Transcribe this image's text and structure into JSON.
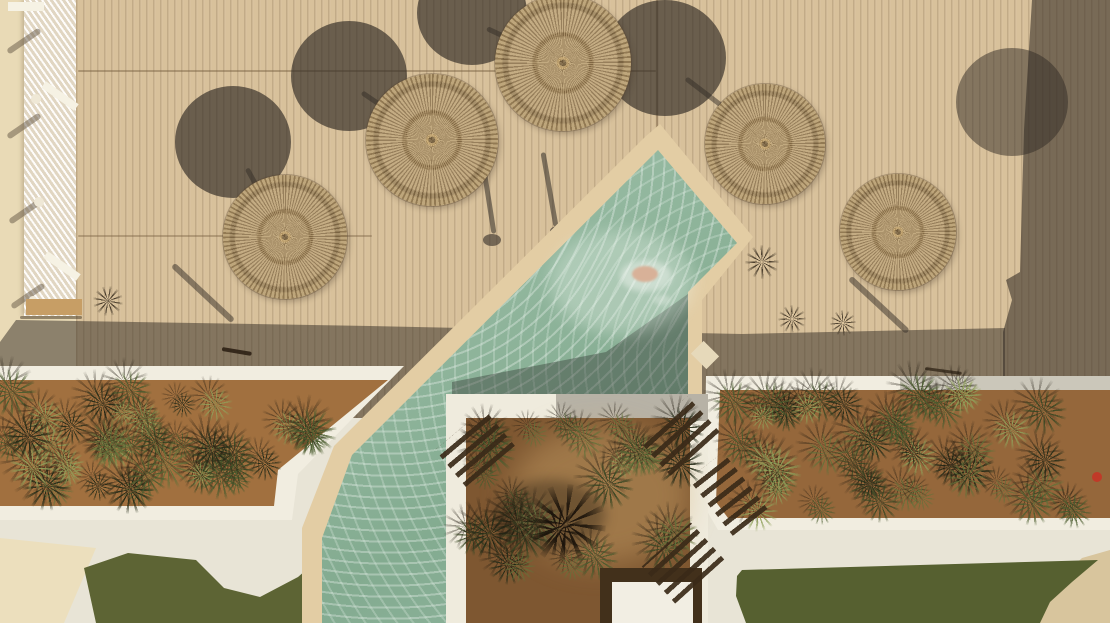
{
  "meta": {
    "description": "Aerial top-down photo of a resort pool deck: five round wicker parasols on tan wood decking casting circular shadows, a diagonal seafoam pool with stone coping, white-walled planters full of agaves, white paths, green lawns and a cream terrace strip with loungers."
  },
  "palette": {
    "ground": "#e7ddc2",
    "cream_strip": "#e9dab6",
    "deck": "#d8c19b",
    "shadow": "rgba(56,48,40,0.55)",
    "umb_shadow": "rgba(48,42,36,0.66)",
    "coping": "#e3cda4",
    "wall_white": "#f1ede0",
    "path": "#e8e4d6",
    "soil_left": "#a1703f",
    "soil_right": "#95673b",
    "soil_center": "#7e5731",
    "lawn_left": "#5d6434",
    "lawn_right": "#566030",
    "sand": "#d8c59d",
    "water_mid": "#92b79e",
    "platform_frame": "#42301b",
    "platform": "#f2eee3",
    "plant_colors": [
      "#252c18",
      "#3a4824",
      "#4a5c2e",
      "#64713a",
      "#8fa05a"
    ]
  },
  "layers": [
    {
      "t": "rect",
      "name": "base-ground",
      "x": 0,
      "y": 0,
      "w": 1110,
      "h": 623,
      "bg": "#e7ddc2"
    },
    {
      "t": "rect",
      "name": "terrace-cream-strip",
      "x": 0,
      "y": 0,
      "w": 80,
      "h": 420,
      "bg": "#e9dab6"
    },
    {
      "t": "rect",
      "name": "wood-deck",
      "x": 76,
      "y": 0,
      "w": 1034,
      "h": 418,
      "bg": "#d8c19b"
    },
    {
      "t": "rect",
      "name": "deck-plank-lines",
      "x": 76,
      "y": 0,
      "w": 1034,
      "h": 418,
      "cls": "planks"
    },
    {
      "t": "line",
      "name": "deck-seam",
      "x1": 78,
      "y1": 71,
      "x2": 656,
      "y2": 71,
      "w": 1.6,
      "bg": "rgba(120,95,65,0.45)"
    },
    {
      "t": "line",
      "name": "deck-seam",
      "x1": 78,
      "y1": 236,
      "x2": 372,
      "y2": 236,
      "w": 1.6,
      "bg": "rgba(120,95,65,0.4)"
    },
    {
      "t": "line",
      "name": "deck-seam",
      "x1": 657,
      "y1": 0,
      "x2": 657,
      "y2": 148,
      "w": 1.8,
      "bg": "rgba(120,95,65,0.5)"
    },
    {
      "t": "rect",
      "name": "hammock-net-fence",
      "x": 24,
      "y": 0,
      "w": 52,
      "h": 316,
      "cls": "net"
    },
    {
      "t": "line",
      "name": "fence-shadow",
      "x1": 40,
      "y1": 30,
      "x2": 8,
      "y2": 52,
      "w": 6,
      "bg": "rgba(100,86,68,0.5)"
    },
    {
      "t": "line",
      "name": "fence-shadow",
      "x1": 40,
      "y1": 115,
      "x2": 8,
      "y2": 137,
      "w": 6,
      "bg": "rgba(100,86,68,0.5)"
    },
    {
      "t": "line",
      "name": "fence-shadow",
      "x1": 42,
      "y1": 200,
      "x2": 10,
      "y2": 222,
      "w": 6,
      "bg": "rgba(100,86,68,0.5)"
    },
    {
      "t": "line",
      "name": "fence-shadow",
      "x1": 44,
      "y1": 285,
      "x2": 12,
      "y2": 307,
      "w": 6,
      "bg": "rgba(100,86,68,0.5)"
    },
    {
      "t": "ell",
      "name": "fence-post",
      "cx": 36,
      "cy": 99,
      "rx": 5,
      "ry": 5,
      "bg": "#efe8d6"
    },
    {
      "t": "ell",
      "name": "fence-post",
      "cx": 39,
      "cy": 202,
      "rx": 5,
      "ry": 5,
      "bg": "#efe8d6"
    },
    {
      "t": "ell",
      "name": "fence-post",
      "cx": 33,
      "cy": 300,
      "rx": 4,
      "ry": 4,
      "bg": "#efe8d6"
    },
    {
      "t": "rect",
      "name": "lounger-frame-bar",
      "x": 40,
      "y": 92,
      "w": 40,
      "h": 8,
      "rot": 35,
      "bg": "#f6f2e4"
    },
    {
      "t": "rect",
      "name": "lounger-frame-bar",
      "x": 42,
      "y": 262,
      "w": 40,
      "h": 8,
      "rot": 35,
      "bg": "#f6f2e4"
    },
    {
      "t": "rect",
      "name": "lounger-frame-bar",
      "x": 8,
      "y": 2,
      "w": 36,
      "h": 9,
      "rot": 0,
      "bg": "#f6f2e4"
    },
    {
      "t": "rect",
      "name": "wooden-bench",
      "x": 26,
      "y": 299,
      "w": 56,
      "h": 16,
      "bg": "#c79e65"
    },
    {
      "t": "line",
      "name": "bench-shadow",
      "x1": 20,
      "y1": 317,
      "x2": 82,
      "y2": 317,
      "w": 3,
      "bg": "rgba(70,55,35,0.5)"
    },
    {
      "t": "poly",
      "name": "building-shadow-right",
      "pts": "1032,0 1110,0 1110,418 1003,418 1003,332 1012,300 1006,280 1020,272 1024,130",
      "bg": "rgba(56,48,40,0.6)"
    },
    {
      "t": "poly",
      "name": "planter-shadow-band",
      "pts": "16,320 370,326 742,334 1005,328 1005,418 0,418 0,342",
      "bg": "rgba(56,48,40,0.52)"
    },
    {
      "t": "ell",
      "name": "parasol-shadow",
      "cx": 233,
      "cy": 142,
      "rx": 58,
      "ry": 56,
      "bg": "rgba(48,42,36,0.66)"
    },
    {
      "t": "ell",
      "name": "parasol-shadow",
      "cx": 349,
      "cy": 76,
      "rx": 58,
      "ry": 55,
      "bg": "rgba(48,42,36,0.66)"
    },
    {
      "t": "ell",
      "name": "parasol-shadow",
      "cx": 472,
      "cy": 13,
      "rx": 55,
      "ry": 52,
      "bg": "rgba(48,42,36,0.66)"
    },
    {
      "t": "ell",
      "name": "parasol-shadow",
      "cx": 665,
      "cy": 58,
      "rx": 61,
      "ry": 58,
      "bg": "rgba(48,42,36,0.66)"
    },
    {
      "t": "ell",
      "name": "parasol-shadow",
      "cx": 1012,
      "cy": 102,
      "rx": 56,
      "ry": 54,
      "bg": "rgba(48,42,36,0.5)"
    },
    {
      "t": "line",
      "name": "parasol-pole-shadow",
      "x1": 247,
      "y1": 168,
      "x2": 283,
      "y2": 234,
      "w": 5,
      "bg": "rgba(50,44,38,0.5)"
    },
    {
      "t": "line",
      "name": "parasol-pole-shadow",
      "x1": 362,
      "y1": 92,
      "x2": 428,
      "y2": 137,
      "w": 5,
      "bg": "rgba(50,44,38,0.5)"
    },
    {
      "t": "line",
      "name": "parasol-pole-shadow",
      "x1": 487,
      "y1": 28,
      "x2": 560,
      "y2": 62,
      "w": 5,
      "bg": "rgba(50,44,38,0.5)"
    },
    {
      "t": "line",
      "name": "parasol-pole-shadow",
      "x1": 686,
      "y1": 78,
      "x2": 766,
      "y2": 139,
      "w": 5,
      "bg": "rgba(50,44,38,0.5)"
    },
    {
      "t": "line",
      "name": "railing-shadow",
      "x1": 173,
      "y1": 265,
      "x2": 233,
      "y2": 321,
      "w": 6,
      "bg": "rgba(50,44,38,0.5)"
    },
    {
      "t": "line",
      "name": "railing-shadow",
      "x1": 850,
      "y1": 278,
      "x2": 908,
      "y2": 332,
      "w": 6,
      "bg": "rgba(50,44,38,0.5)"
    },
    {
      "t": "line",
      "name": "pole-shadow-wavy",
      "x1": 481,
      "y1": 150,
      "x2": 494,
      "y2": 233,
      "w": 5,
      "bg": "rgba(50,44,38,0.55)"
    },
    {
      "t": "line",
      "name": "pole-shadow-wavy",
      "x1": 543,
      "y1": 152,
      "x2": 556,
      "y2": 226,
      "w": 5,
      "bg": "rgba(50,44,38,0.55)"
    },
    {
      "t": "ell",
      "name": "pole-base-shadow",
      "cx": 492,
      "cy": 240,
      "rx": 9,
      "ry": 6,
      "bg": "rgba(50,44,38,0.6)"
    },
    {
      "t": "ell",
      "name": "pole-base-shadow",
      "cx": 558,
      "cy": 231,
      "rx": 8,
      "ry": 5,
      "bg": "rgba(50,44,38,0.6)"
    },
    {
      "t": "tuft",
      "name": "grass-tuft",
      "cx": 108,
      "cy": 301,
      "r": 15
    },
    {
      "t": "tuft",
      "name": "grass-tuft",
      "cx": 762,
      "cy": 262,
      "r": 17
    },
    {
      "t": "tuft",
      "name": "grass-tuft",
      "cx": 792,
      "cy": 319,
      "r": 14
    },
    {
      "t": "tuft",
      "name": "grass-tuft",
      "cx": 843,
      "cy": 323,
      "r": 13
    },
    {
      "t": "line",
      "name": "stick-on-deck",
      "x1": 222,
      "y1": 349,
      "x2": 252,
      "y2": 354,
      "w": 4,
      "bg": "rgba(40,28,16,0.85)"
    },
    {
      "t": "line",
      "name": "hose-on-deck",
      "x1": 925,
      "y1": 368,
      "x2": 962,
      "y2": 373,
      "w": 3,
      "bg": "rgba(40,28,16,0.7)"
    },
    {
      "t": "umb",
      "name": "wicker-parasol",
      "cx": 285,
      "cy": 237,
      "r": 62
    },
    {
      "t": "umb",
      "name": "wicker-parasol",
      "cx": 432,
      "cy": 140,
      "r": 66
    },
    {
      "t": "umb",
      "name": "wicker-parasol",
      "cx": 563,
      "cy": 63,
      "r": 68
    },
    {
      "t": "umb",
      "name": "wicker-parasol",
      "cx": 765,
      "cy": 144,
      "r": 60
    },
    {
      "t": "umb",
      "name": "wicker-parasol",
      "cx": 898,
      "cy": 232,
      "r": 58
    },
    {
      "t": "rect",
      "name": "pool-surround-path",
      "x": 0,
      "y": 418,
      "w": 1110,
      "h": 205,
      "bg": "#e8e4d6",
      "cls": "terr"
    },
    {
      "t": "poly",
      "name": "cream-terrace-corner",
      "pts": "0,538 96,548 64,623 0,623",
      "bg": "#ecdfbd"
    },
    {
      "t": "poly",
      "name": "lawn-left",
      "pts": "84,568 128,553 196,560 224,588 260,597 298,577 320,558 322,623 96,623",
      "bg": "#5d6434",
      "cls": "lawn"
    },
    {
      "t": "poly",
      "name": "sand-corner",
      "pts": "1036,623 1110,623 1110,550 1082,558 1052,586 1038,606",
      "bg": "#d8c59d"
    },
    {
      "t": "poly",
      "name": "lawn-right",
      "pts": "737,576 742,570 1098,560 1072,582 1050,602 1040,623 746,623 736,596",
      "bg": "#566030",
      "cls": "lawn"
    },
    {
      "t": "poly",
      "name": "pool-stone-coping",
      "pts": "646,136 660,124 753,237 702,300 702,402 454,402 454,623 302,623 302,528 334,446",
      "bg": "#e3cda4"
    },
    {
      "t": "poly",
      "name": "pool-water",
      "pts": "658,150 737,243 688,292 688,396 447,396 447,623 322,623 322,538 352,455",
      "cls": "water"
    },
    {
      "t": "poly",
      "name": "pool-water-sparkle",
      "pts": "658,150 737,243 688,292 688,396 447,396 447,623 322,623 322,538 352,455",
      "cls": "sparkle"
    },
    {
      "t": "poly",
      "name": "wall-shadow-on-water",
      "pts": "452,382 606,352 688,294 688,396 452,396",
      "bg": "rgba(52,58,52,0.42)"
    },
    {
      "t": "ell",
      "name": "sun-glare-on-water",
      "cx": 622,
      "cy": 282,
      "rx": 72,
      "ry": 52,
      "bg": "rgba(240,248,240,0.32)",
      "blur": 8
    },
    {
      "t": "ell",
      "name": "swimmer-splash",
      "cx": 646,
      "cy": 276,
      "rx": 26,
      "ry": 16,
      "bg": "rgba(238,244,238,0.5)",
      "blur": 3
    },
    {
      "t": "ell",
      "name": "swimmer",
      "cx": 645,
      "cy": 274,
      "rx": 13,
      "ry": 8,
      "bg": "#d8b198",
      "blur": 1
    },
    {
      "t": "ell",
      "name": "swimmer-ripple",
      "cx": 662,
      "cy": 300,
      "rx": 9,
      "ry": 5,
      "bg": "rgba(230,238,230,0.4)",
      "blur": 2
    },
    {
      "t": "rect",
      "name": "pool-skimmer-lid",
      "x": 694,
      "y": 346,
      "w": 22,
      "h": 18,
      "rot": 45,
      "bg": "#e6d9ba"
    },
    {
      "t": "poly",
      "name": "planter-wall-left",
      "pts": "0,366 404,366 298,474 292,520 0,520",
      "bg": "#f1ede0"
    },
    {
      "t": "poly",
      "name": "planter-soil-left",
      "pts": "0,380 388,380 278,470 274,506 0,506",
      "bg": "#a1703f",
      "cls": "soilbg"
    },
    {
      "t": "field",
      "name": "agave-bed-left",
      "x": 8,
      "y": 386,
      "w": 366,
      "h": 114,
      "n": 44,
      "seed": 7,
      "smin": 26,
      "smax": 50,
      "maxsum": 756
    },
    {
      "t": "poly",
      "name": "planter-wall-right",
      "pts": "706,376 1110,376 1110,530 718,530 704,506",
      "bg": "#f1ede0"
    },
    {
      "t": "rect",
      "name": "planter-wall-shade",
      "x": 900,
      "y": 376,
      "w": 210,
      "h": 15,
      "bg": "rgba(70,62,52,0.22)"
    },
    {
      "t": "poly",
      "name": "planter-soil-right",
      "pts": "720,390 1110,390 1110,518 728,518 716,502",
      "bg": "#95673b",
      "cls": "soilbg"
    },
    {
      "t": "field",
      "name": "agave-bed-right",
      "x": 726,
      "y": 395,
      "w": 376,
      "h": 117,
      "n": 46,
      "seed": 11,
      "smin": 26,
      "smax": 50
    },
    {
      "t": "poly",
      "name": "planter-wall-center",
      "pts": "446,394 708,394 708,623 446,623",
      "bg": "#efebdd"
    },
    {
      "t": "rect",
      "name": "planter-wall-shade",
      "x": 556,
      "y": 394,
      "w": 152,
      "h": 27,
      "bg": "rgba(66,60,50,0.32)"
    },
    {
      "t": "poly",
      "name": "planter-soil-center",
      "pts": "466,418 690,418 690,623 466,623",
      "bg": "#7e5731",
      "cls": "soilbg"
    },
    {
      "t": "ell",
      "name": "soil-light-patch",
      "cx": 600,
      "cy": 495,
      "rx": 90,
      "ry": 70,
      "bg": "rgba(210,170,110,0.4)",
      "blur": 14
    },
    {
      "t": "field",
      "name": "garden-bed-center",
      "x": 472,
      "y": 424,
      "w": 212,
      "h": 192,
      "n": 26,
      "seed": 23,
      "smin": 28,
      "smax": 52,
      "avoid": [
        596,
        564,
        708,
        623
      ]
    },
    {
      "t": "ell",
      "name": "agave-shadow",
      "cx": 550,
      "cy": 515,
      "rx": 55,
      "ry": 35,
      "bg": "rgba(40,30,18,0.4)",
      "blur": 6
    },
    {
      "t": "tuft",
      "name": "twisted-agave",
      "cx": 566,
      "cy": 524,
      "r": 40,
      "c": "rgba(25,18,10,0.92)"
    },
    {
      "t": "tuft",
      "name": "twisted-agave",
      "cx": 558,
      "cy": 530,
      "r": 26,
      "c": "rgba(25,18,10,0.92)"
    },
    {
      "t": "rect",
      "name": "daybed-frame",
      "x": 600,
      "y": 568,
      "w": 102,
      "h": 55,
      "bg": "#42301b"
    },
    {
      "t": "rect",
      "name": "daybed-white-platform",
      "x": 612,
      "y": 582,
      "w": 81,
      "h": 41,
      "bg": "#f2eee3"
    },
    {
      "t": "fork",
      "name": "slatted-lounger",
      "x": 443,
      "y": 424,
      "w": 64,
      "h": 48,
      "rot": -40
    },
    {
      "t": "fork",
      "name": "slatted-lounger",
      "x": 646,
      "y": 412,
      "w": 66,
      "h": 48,
      "rot": -42
    },
    {
      "t": "fork",
      "name": "slatted-lounger",
      "x": 650,
      "y": 538,
      "w": 66,
      "h": 50,
      "rot": -42
    },
    {
      "t": "fork",
      "name": "slatted-lounger",
      "x": 706,
      "y": 458,
      "w": 44,
      "h": 72,
      "rot": -38
    },
    {
      "t": "ell",
      "name": "red-object",
      "cx": 1097,
      "cy": 477,
      "rx": 5,
      "ry": 5,
      "bg": "#c03a28"
    }
  ]
}
